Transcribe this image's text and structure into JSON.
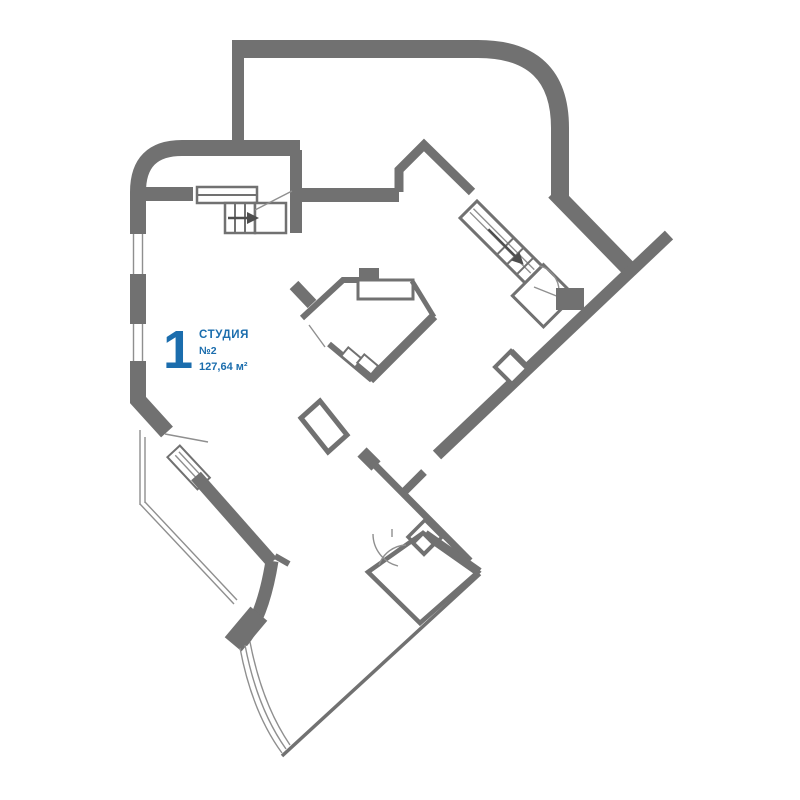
{
  "unit_card": {
    "number": "1",
    "type": "СТУДИЯ",
    "unit": "№2",
    "area": "127,64 м²"
  },
  "colors": {
    "wall": "#717171",
    "glass": "#8f8f8f",
    "arrow": "#4e4e4e",
    "accent": "#1b6dad",
    "bg": "#ffffff"
  }
}
